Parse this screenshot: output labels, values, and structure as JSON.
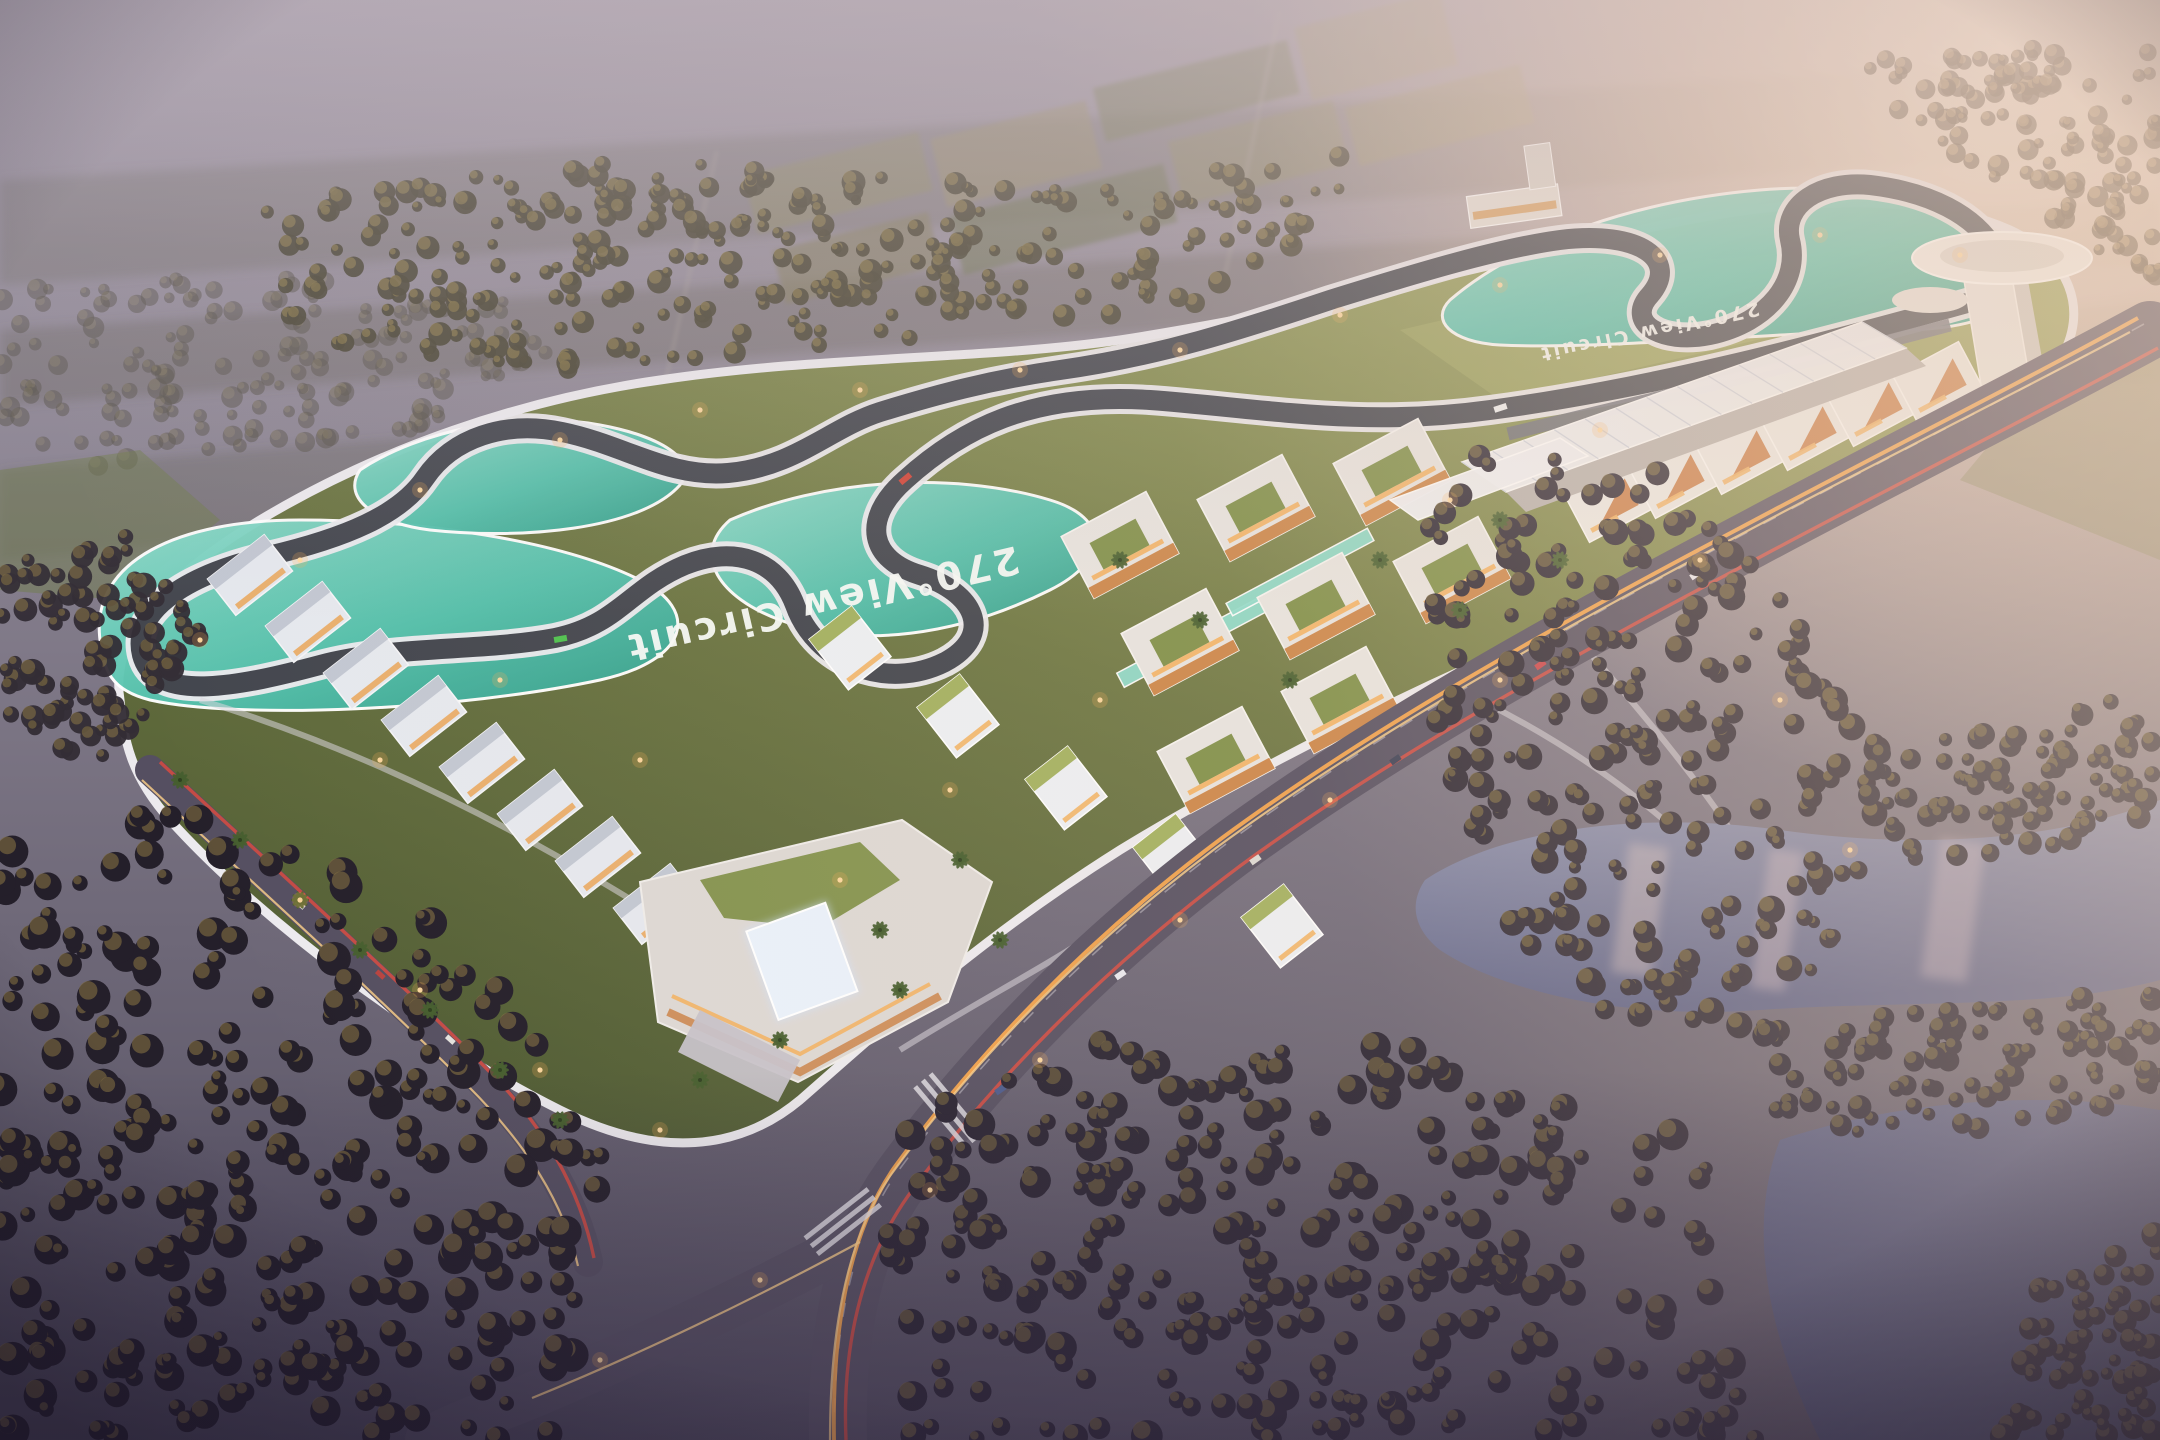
{
  "scene": {
    "description": "Aerial dusk rendering of a motorsport circuit resort: winding race track with teal runoff areas, white paddock and villa buildings with rooftop gardens, control tower, grandstand canopy, highway with light trails, lakes and dark forests under a hazy sunset sky."
  },
  "labels": {
    "track_surface_text": "270°View Circuit",
    "track_surface_text_2": "270°View Circuit"
  },
  "palette": {
    "haze_top": "#a39aa6",
    "haze_mid": "#8b8492",
    "ground_dark": "#5f5a6a",
    "sun_glow": "#ffeedd",
    "warm_wash": "#f4d6ba",
    "grass_lit": "#99a159",
    "grass_mid": "#6c7642",
    "grass_dark": "#4e5a33",
    "asphalt": "#43464e",
    "white_line": "#eceaee",
    "teal": "#54c2ae",
    "teal_light": "#8fdccb",
    "teal_deep": "#2f9d8a",
    "road": "#554f61",
    "trail_orange": "#ffa84a",
    "trail_red": "#e04a3f",
    "building_white": "#e8e6e2",
    "accent_orange": "#c9803f",
    "window_warm": "#f2b264",
    "roof_green": "#7e8f48",
    "lake_light": "#8b90ae",
    "lake_deep": "#41466a",
    "forest_dark": "#241f2a",
    "forest_lit": "#7c6a40"
  }
}
